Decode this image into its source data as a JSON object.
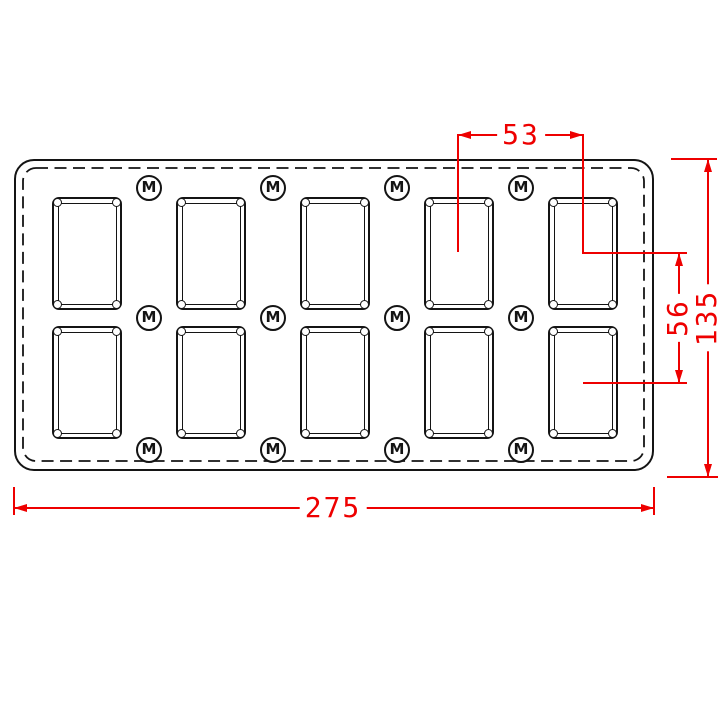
{
  "drawing": {
    "description": "Engineering drawing of a rectangular switch plate, front view",
    "marker_label": "M",
    "openings": {
      "rows": 2,
      "columns": 5,
      "count": 10,
      "column_lefts": [
        52,
        176,
        300,
        424,
        548
      ],
      "row_tops": [
        197,
        326
      ],
      "width": 70,
      "height": 113
    },
    "markers": {
      "count": 12,
      "center_xs": [
        149,
        273,
        397,
        521
      ],
      "center_ys": [
        188,
        318,
        450
      ]
    },
    "dimensions": {
      "opening_pitch_horizontal": "53",
      "opening_pitch_vertical": "56",
      "plate_height": "135",
      "plate_width": "275"
    },
    "colors": {
      "dimension_red": "#ee0000",
      "line_black": "#141414",
      "background": "#ffffff"
    }
  }
}
